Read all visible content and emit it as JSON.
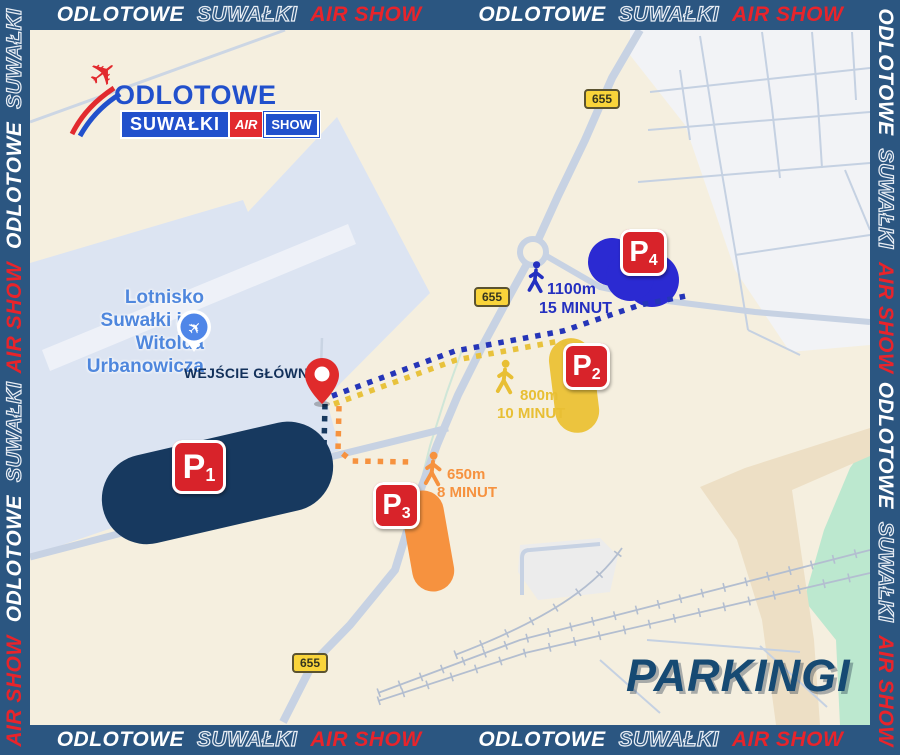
{
  "frame": {
    "odlotowe": "ODLOTOWE",
    "suwalki": "SUWAŁKI",
    "airshow": "AIR SHOW"
  },
  "logo": {
    "title": "ODLOTOWE",
    "city": "SUWAŁKI",
    "air": "AIR",
    "show": "SHOW"
  },
  "map": {
    "airport_label": "Lotnisko\nSuwałki im.\nWitolda\nUrbanowicza",
    "entrance_label": "WEJŚCIE GŁÓWNE",
    "page_title": "PARKINGI",
    "road_number": "655"
  },
  "parkings": {
    "p1": {
      "letter": "P",
      "number": "1"
    },
    "p2": {
      "letter": "P",
      "number": "2",
      "distance": "800m",
      "time": "10 MINUT"
    },
    "p3": {
      "letter": "P",
      "number": "3",
      "distance": "650m",
      "time": "8 MINUT"
    },
    "p4": {
      "letter": "P",
      "number": "4",
      "distance": "1100m",
      "time": "15 MINUT"
    }
  },
  "colors": {
    "frame_navy": "#2b5681",
    "dark_navy": "#17395f",
    "royal_blue": "#2b2ad2",
    "yellow": "#ecc43e",
    "orange": "#f6923f",
    "badge_red": "#d8232a",
    "map_cream": "#f5efdf",
    "airport_fill": "#dce4f2",
    "brand_blue": "#2150cc"
  }
}
